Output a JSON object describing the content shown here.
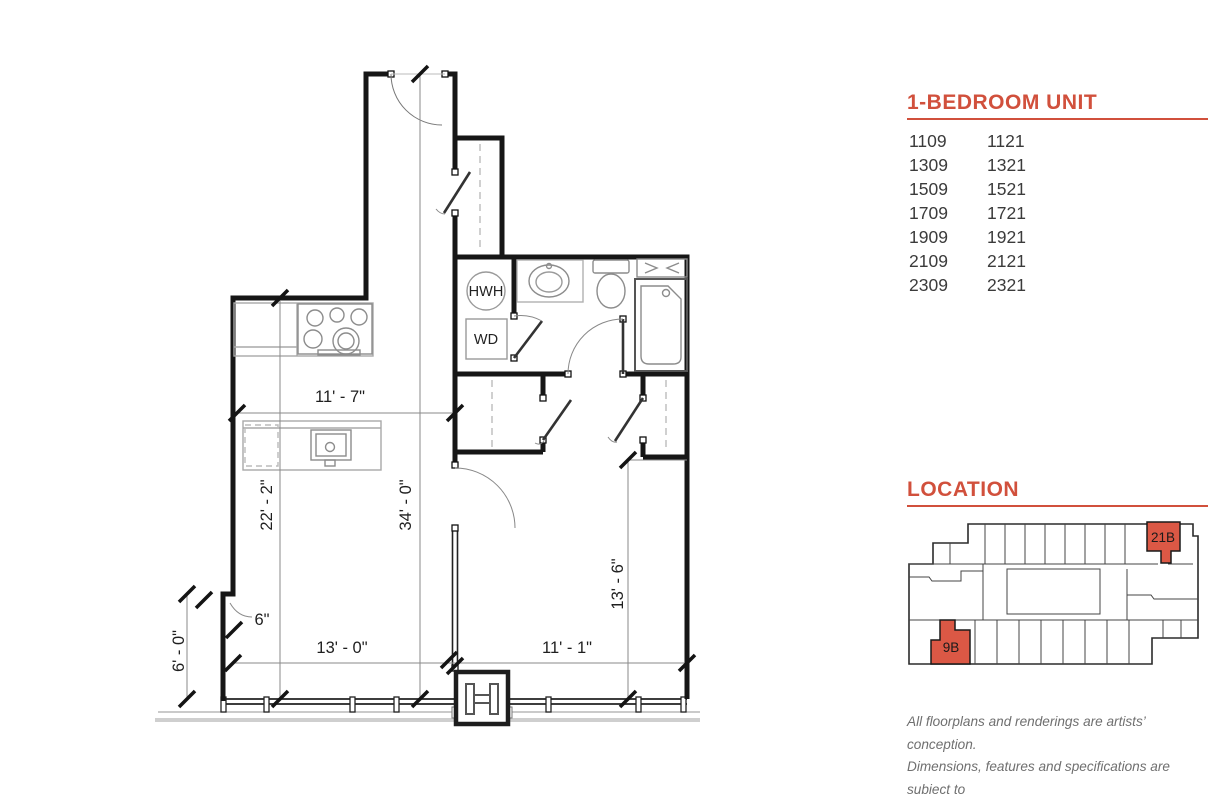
{
  "unit_panel": {
    "title": "1-BEDROOM UNIT",
    "rows": [
      {
        "left": "1109",
        "right": "1121"
      },
      {
        "left": "1309",
        "right": "1321"
      },
      {
        "left": "1509",
        "right": "1521"
      },
      {
        "left": "1709",
        "right": "1721"
      },
      {
        "left": "1909",
        "right": "1921"
      },
      {
        "left": "2109",
        "right": "2121"
      },
      {
        "left": "2309",
        "right": "2321"
      }
    ]
  },
  "location_panel": {
    "title": "LOCATION",
    "highlighted_unit_top": "21B",
    "highlighted_unit_bottom": "9B"
  },
  "floorplan": {
    "dims": {
      "top_width": "11' - 7\"",
      "living_height": "22' - 2\"",
      "overall_height": "34' - 0\"",
      "bedroom_height": "13' - 6\"",
      "living_width": "13' - 0\"",
      "bedroom_width": "11' - 1\"",
      "jog_width": "6\"",
      "lower_left_height": "6' - 0\""
    },
    "labels": {
      "water_heater": "HWH",
      "washer_dryer": "WD"
    }
  },
  "disclaimer": {
    "line1": "All floorplans and renderings are artists’ conception.",
    "line2": "Dimensions, features and specifications are subject to",
    "line3": "change at the discretion of the builder."
  },
  "colors": {
    "accent": "#d1503c",
    "map_highlight": "#db5845"
  }
}
